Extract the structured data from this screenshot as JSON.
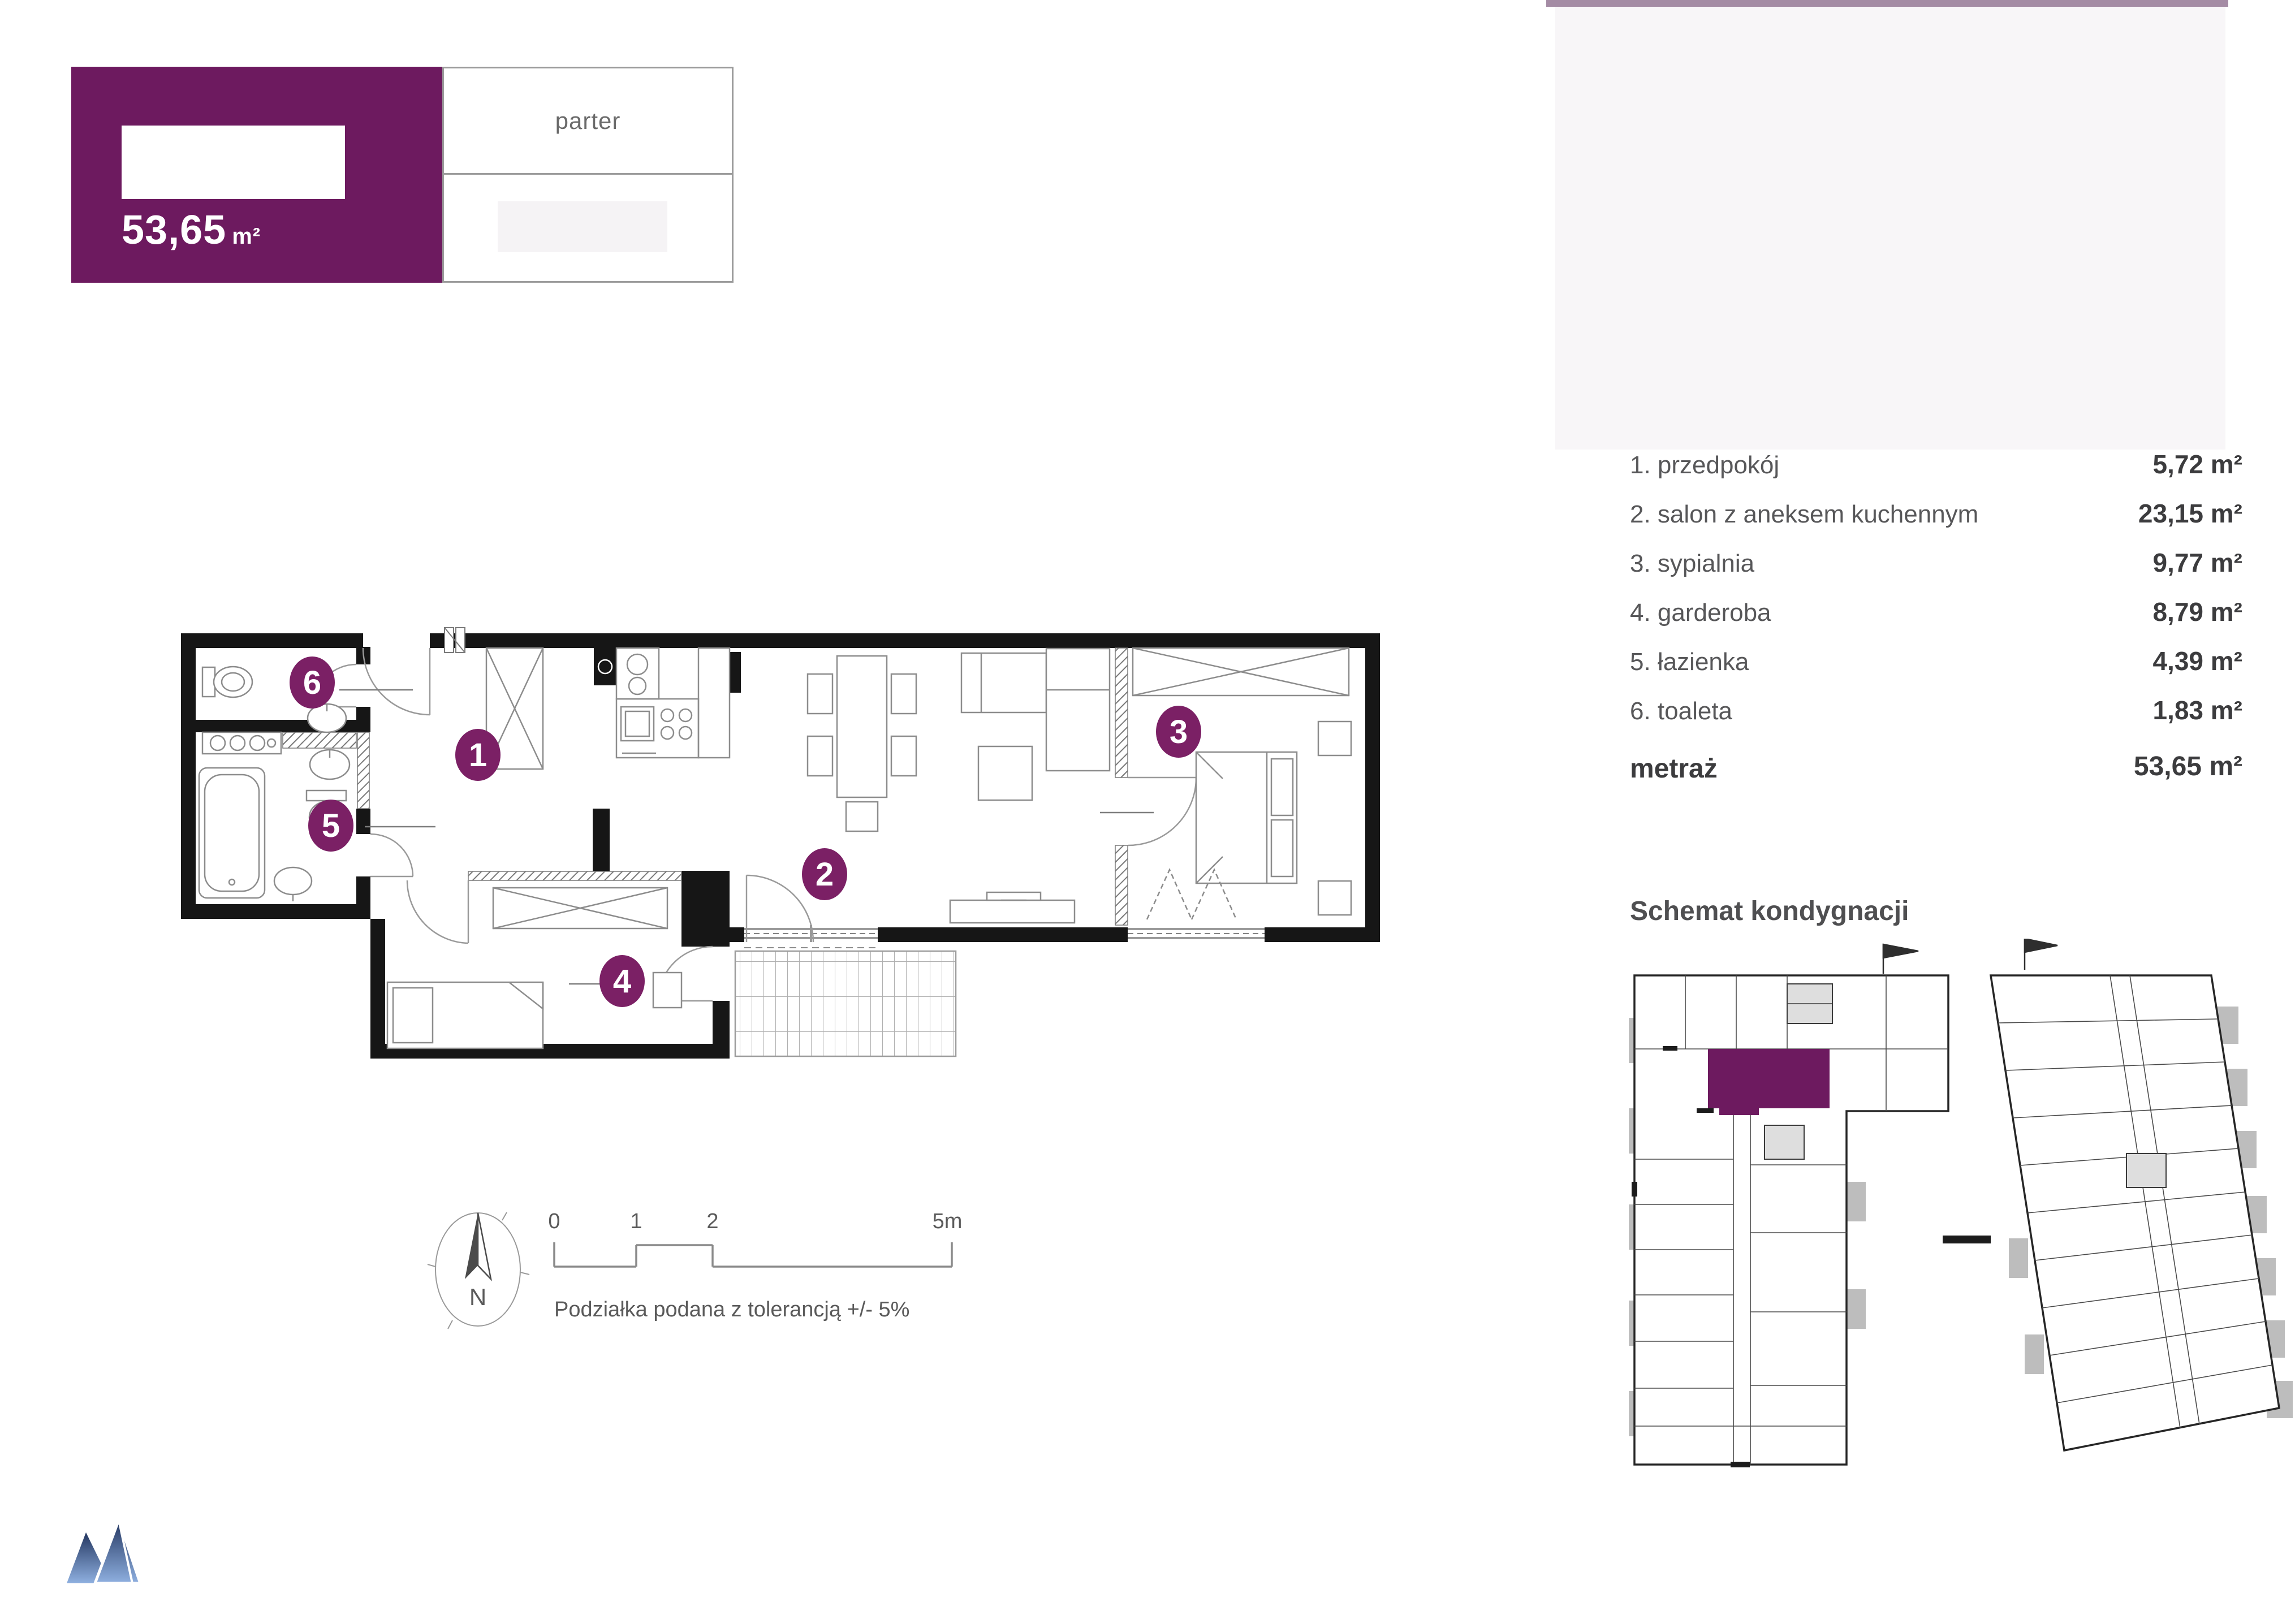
{
  "header": {
    "area_value": "53,65",
    "area_unit": "m²",
    "floor_label": "parter"
  },
  "rooms": [
    {
      "label": "1. przedpokój",
      "value": "5,72 m²"
    },
    {
      "label": "2. salon z aneksem kuchennym",
      "value": "23,15 m²"
    },
    {
      "label": "3. sypialnia",
      "value": "9,77 m²"
    },
    {
      "label": "4. garderoba",
      "value": "8,79 m²"
    },
    {
      "label": "5. łazienka",
      "value": "4,39 m²"
    },
    {
      "label": "6. toaleta",
      "value": "1,83 m²"
    }
  ],
  "total": {
    "label": "metraż",
    "value": "53,65 m²"
  },
  "floor_schematic": {
    "title": "Schemat kondygnacji"
  },
  "plan": {
    "badges": [
      {
        "n": "1"
      },
      {
        "n": "2"
      },
      {
        "n": "3"
      },
      {
        "n": "4"
      },
      {
        "n": "5"
      },
      {
        "n": "6"
      }
    ]
  },
  "scalebar": {
    "t0": "0",
    "t1": "1",
    "t2": "2",
    "t5": "5m",
    "caption": "Podziałka podana z tolerancją +/- 5%"
  },
  "compass": {
    "north": "N"
  },
  "colors": {
    "brand_purple": "#6d1a5f",
    "badge_purple": "#7b2065",
    "mauve_bar": "#a48ba4",
    "panel_gray": "#f8f6f8",
    "text_gray": "#575759",
    "logo_blue_dark": "#22355f",
    "logo_blue_light": "#8fb0e0"
  }
}
